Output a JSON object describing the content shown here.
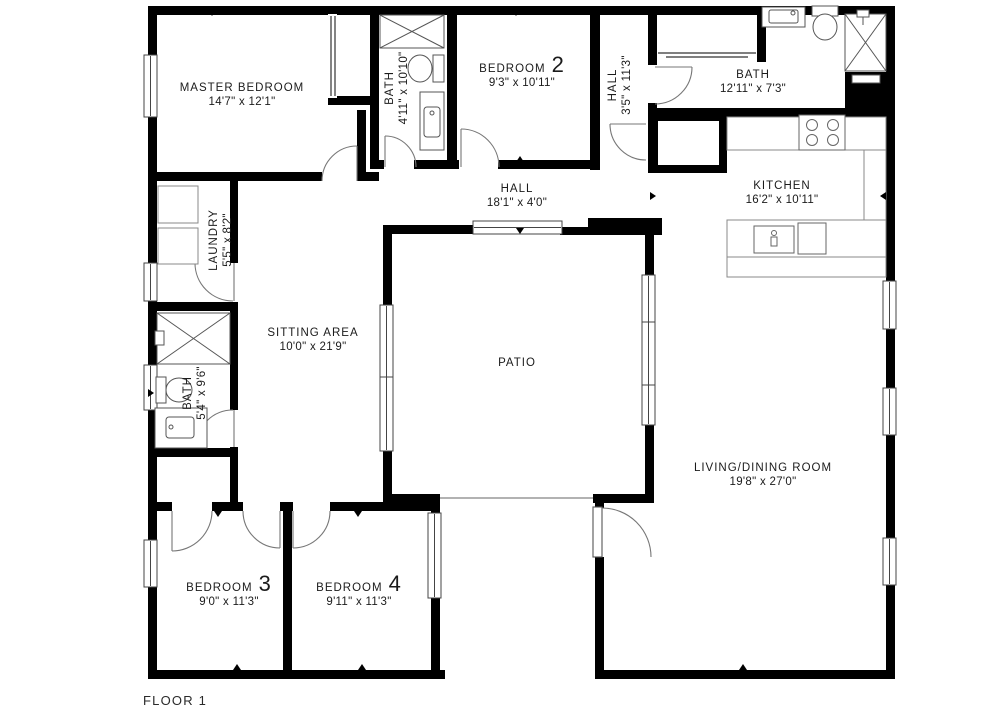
{
  "floor_label": "FLOOR 1",
  "colors": {
    "walls": "#000000",
    "background": "#ffffff",
    "fixture_outline": "#666666"
  },
  "rooms": {
    "master": {
      "name": "MASTER BEDROOM",
      "dims": "14'7\" x 12'1\""
    },
    "bath_top": {
      "name": "BATH",
      "dims": "4'11\" x 10'10\""
    },
    "bedroom2": {
      "name": "BEDROOM",
      "number": "2",
      "dims": "9'3\" x 10'11\""
    },
    "hall_v": {
      "name": "HALL",
      "dims": "3'5\" x 11'3\""
    },
    "bath_right": {
      "name": "BATH",
      "dims": "12'11\" x 7'3\""
    },
    "kitchen": {
      "name": "KITCHEN",
      "dims": "16'2\" x 10'11\""
    },
    "hall_h": {
      "name": "HALL",
      "dims": "18'1\" x 4'0\""
    },
    "laundry": {
      "name": "LAUNDRY",
      "dims": "5'5\" x 8'2\""
    },
    "sitting": {
      "name": "SITTING AREA",
      "dims": "10'0\" x 21'9\""
    },
    "patio": {
      "name": "PATIO"
    },
    "bath_left": {
      "name": "BATH",
      "dims": "5'4\" x 9'6\""
    },
    "living": {
      "name": "LIVING/DINING ROOM",
      "dims": "19'8\" x 27'0\""
    },
    "bedroom3": {
      "name": "BEDROOM",
      "number": "3",
      "dims": "9'0\" x 11'3\""
    },
    "bedroom4": {
      "name": "BEDROOM",
      "number": "4",
      "dims": "9'11\" x 11'3\""
    }
  }
}
